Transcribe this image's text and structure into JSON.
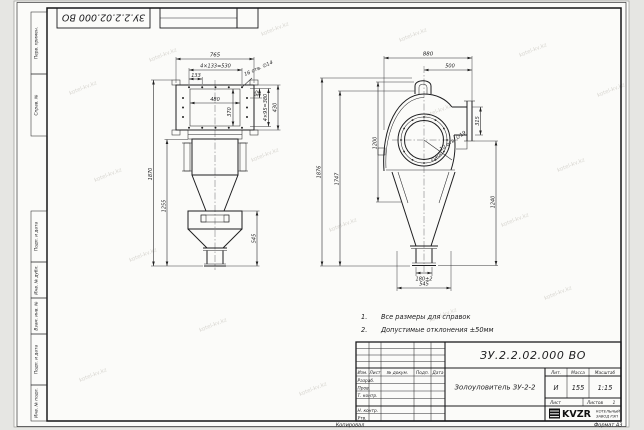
{
  "sheet": {
    "watermark": "kotel-kv.kz",
    "footer_left": "Копировал",
    "footer_right": "Формат А3"
  },
  "top_stamp": {
    "doc_number": "ЗУ.2.2.02.000 ВО"
  },
  "margin_columns": {
    "perv_primen": "Перв. примен.",
    "sprav_no": "Справ. №",
    "podp_data_1": "Подп. и дата",
    "inv_dubl": "Инв. № дубл.",
    "vzam_inv": "Взам. инв. №",
    "podp_data_2": "Подп. и дата",
    "inv_podl": "Инв. № подл."
  },
  "notes": {
    "item1_no": "1.",
    "item1": "Все размеры для справок",
    "item2_no": "2.",
    "item2": "Допустимые отклонения ±50мм"
  },
  "front_view": {
    "dim_765": "765",
    "dim_530": "4×133=530",
    "dim_133": "133",
    "dim_480": "480",
    "dim_370": "370",
    "dim_95": "95",
    "dim_380": "4×95=380",
    "dim_430": "430",
    "holes_label": "16 отв. ∅14",
    "dim_1870": "1870",
    "dim_1255": "1255",
    "dim_545": "545"
  },
  "side_view": {
    "dim_880": "880",
    "dim_500": "500",
    "dim_315": "315",
    "dim_1200": "1200",
    "dim_1747": "1747",
    "dim_1876": "1876",
    "dim_1240": "1240",
    "holes_label": "12 отв. ∅19",
    "dia_label": "∅400",
    "dim_180": "180±2",
    "dim_545": "545"
  },
  "title_block": {
    "doc_number": "ЗУ.2.2.02.000 ВО",
    "product_name": "Золоуловитель ЗУ-2-2",
    "col_izm": "Изм.",
    "col_list": "Лист",
    "col_doc": "№ докум.",
    "col_podp": "Подп.",
    "col_data": "Дата",
    "row_razrab": "Разраб.",
    "row_prov": "Пров.",
    "row_tkontr": "Т. контр.",
    "row_nkontr": "Н. контр.",
    "row_utv": "Утв.",
    "lit_label": "Лит.",
    "lit_value": "И",
    "mass_label": "Масса",
    "mass_value": "155",
    "scale_label": "Масштаб",
    "scale_value": "1:15",
    "sheet_label": "Лист",
    "sheets_label": "Листов",
    "sheets_value": "1",
    "company_name": "KVZR",
    "company_line1": "КОТЕЛЬНЫЙ",
    "company_line2": "ЗАВОД РЭП"
  }
}
